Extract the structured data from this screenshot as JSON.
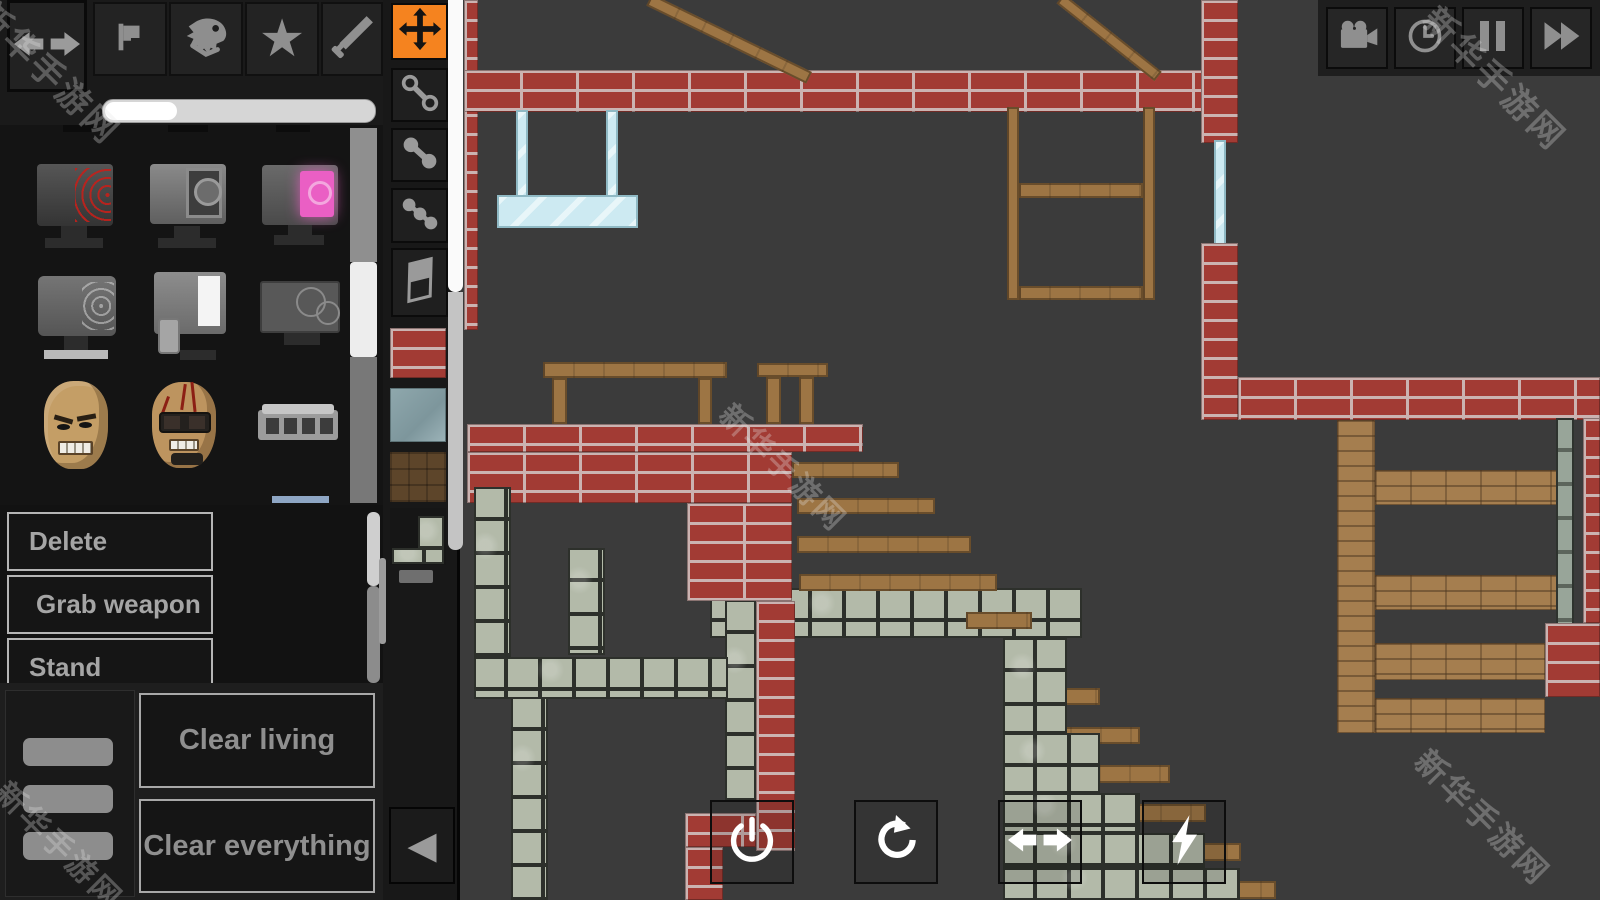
{
  "watermark": {
    "text": "新华手游网"
  },
  "top_toolbar": {
    "icons": [
      {
        "name": "pan-arrows"
      },
      {
        "name": "flag"
      },
      {
        "name": "dino-skull"
      },
      {
        "name": "star"
      },
      {
        "name": "sword"
      }
    ]
  },
  "size_slider": {
    "fraction": 0.27
  },
  "item_library": {
    "items": [
      {
        "name": "machine-red-emitter"
      },
      {
        "name": "machine-camera-lens"
      },
      {
        "name": "machine-pink-screen"
      },
      {
        "name": "machine-coil"
      },
      {
        "name": "machine-white-panel"
      },
      {
        "name": "machine-flat-device"
      },
      {
        "name": "human-head"
      },
      {
        "name": "head-with-goggles"
      },
      {
        "name": "metal-device"
      }
    ]
  },
  "context_menu": {
    "items": [
      {
        "label": "Delete"
      },
      {
        "label": "Grab weapon"
      },
      {
        "label": "Stand"
      }
    ]
  },
  "action_panel": {
    "buttons": [
      {
        "label": "Clear living"
      },
      {
        "label": "Clear everything"
      }
    ],
    "collapse_glyph": "◀"
  },
  "tool_palette": {
    "tools": [
      {
        "name": "move-tool",
        "selected": true
      },
      {
        "name": "chain-link-tool"
      },
      {
        "name": "rigid-joint-tool"
      },
      {
        "name": "ball-chain-tool"
      },
      {
        "name": "eraser-tool"
      }
    ],
    "materials": [
      {
        "name": "brick-block"
      },
      {
        "name": "glass-block"
      },
      {
        "name": "wood-block"
      },
      {
        "name": "metal-block"
      }
    ]
  },
  "playback_toolbar": {
    "buttons": [
      {
        "name": "camera"
      },
      {
        "name": "time"
      },
      {
        "name": "pause"
      },
      {
        "name": "fast-forward"
      }
    ]
  },
  "scene_controls": {
    "buttons": [
      {
        "name": "power"
      },
      {
        "name": "rotate"
      },
      {
        "name": "flip"
      },
      {
        "name": "energy"
      }
    ]
  },
  "colors": {
    "accent_orange": "#f5831f",
    "canvas_bg": "#3b3b3b",
    "panel_bg": "#161616",
    "brick_red": "#a23b34",
    "brick_tan": "#a57e4f",
    "wood_brown": "#9d7544",
    "stone_gray": "#b3baa9",
    "glass_blue": "#cdeaf2",
    "highlight_blue": "#8ea6c4"
  }
}
